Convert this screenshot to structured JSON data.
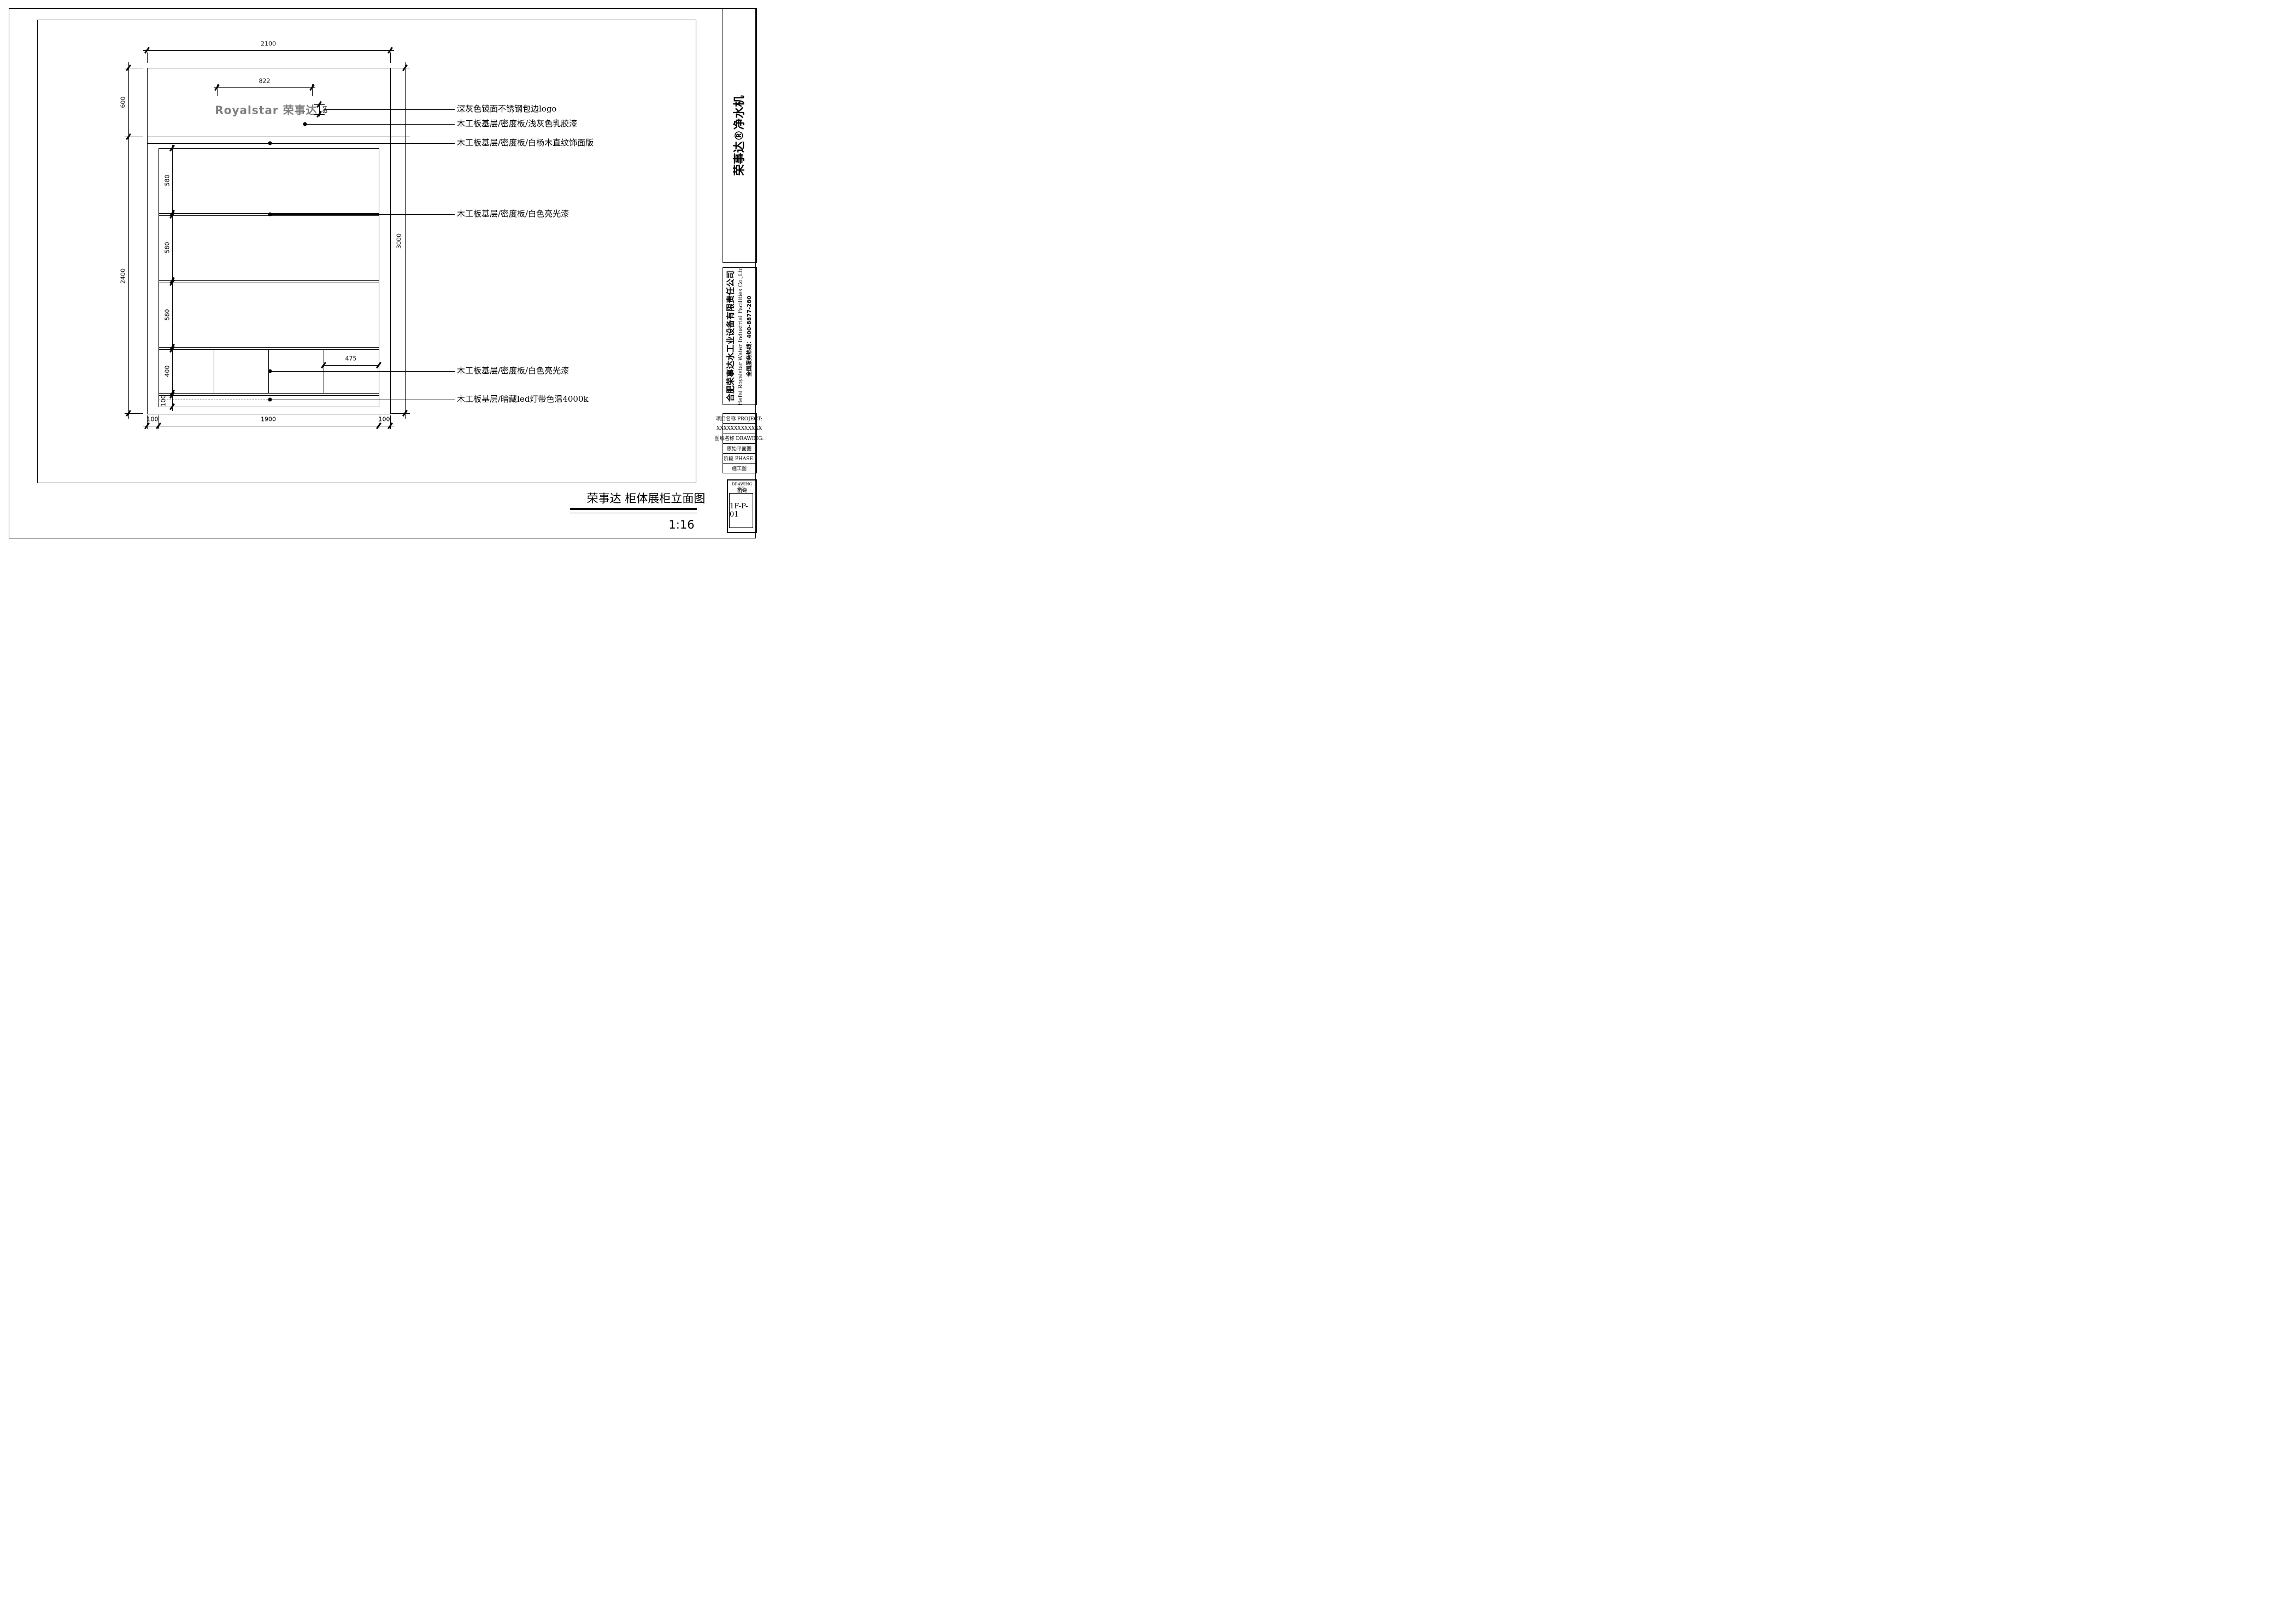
{
  "drawing": {
    "logo_text": "Royalstar 荣事达",
    "logo_color": "#7e7e7e"
  },
  "dims": {
    "overall_width": "2100",
    "logo_width": "822",
    "logo_height": "84",
    "header_height": "600",
    "body_height": "2400",
    "overall_height": "3000",
    "shelf_1": "580",
    "shelf_2": "580",
    "shelf_3": "580",
    "drawer_band": "400",
    "base_height": "100",
    "compartment_width": "475",
    "bottom_left": "100",
    "bottom_span": "1900",
    "bottom_right": "100"
  },
  "annotations": [
    {
      "text": "深灰色镜面不锈钢包边logo"
    },
    {
      "text": "木工板基层/密度板/浅灰色乳胶漆"
    },
    {
      "text": "木工板基层/密度板/白杨木直纹饰面版"
    },
    {
      "text": "木工板基层/密度板/白色亮光漆"
    },
    {
      "text": "木工板基层/密度板/白色亮光漆"
    },
    {
      "text": "木工板基层/暗藏led灯带色温4000k"
    }
  ],
  "sidebar": {
    "brand": "荣事达®净水机",
    "company_cn": "合肥荣事达水工业设备有限责任公司",
    "company_en": "Hefei Royalstar Water Industrial Facilities Co.,Ltd",
    "hotline": "全国服务热线：400-8877-280",
    "fields": [
      {
        "label": "项目名称 PROJECT:"
      },
      {
        "label": "XXXXXXXXXXXXX"
      },
      {
        "label": "图纸名称 DRAWING:"
      },
      {
        "label": "原始平面图"
      },
      {
        "label": "阶段 PHASE:"
      },
      {
        "label": "施工图"
      }
    ],
    "drawing_no": {
      "label_en": "DRAWING NO.",
      "label_cn": "图号",
      "value": "1F-P-01"
    }
  },
  "footer": {
    "title": "荣事达 柜体展柜立面图",
    "scale": "1:16"
  }
}
